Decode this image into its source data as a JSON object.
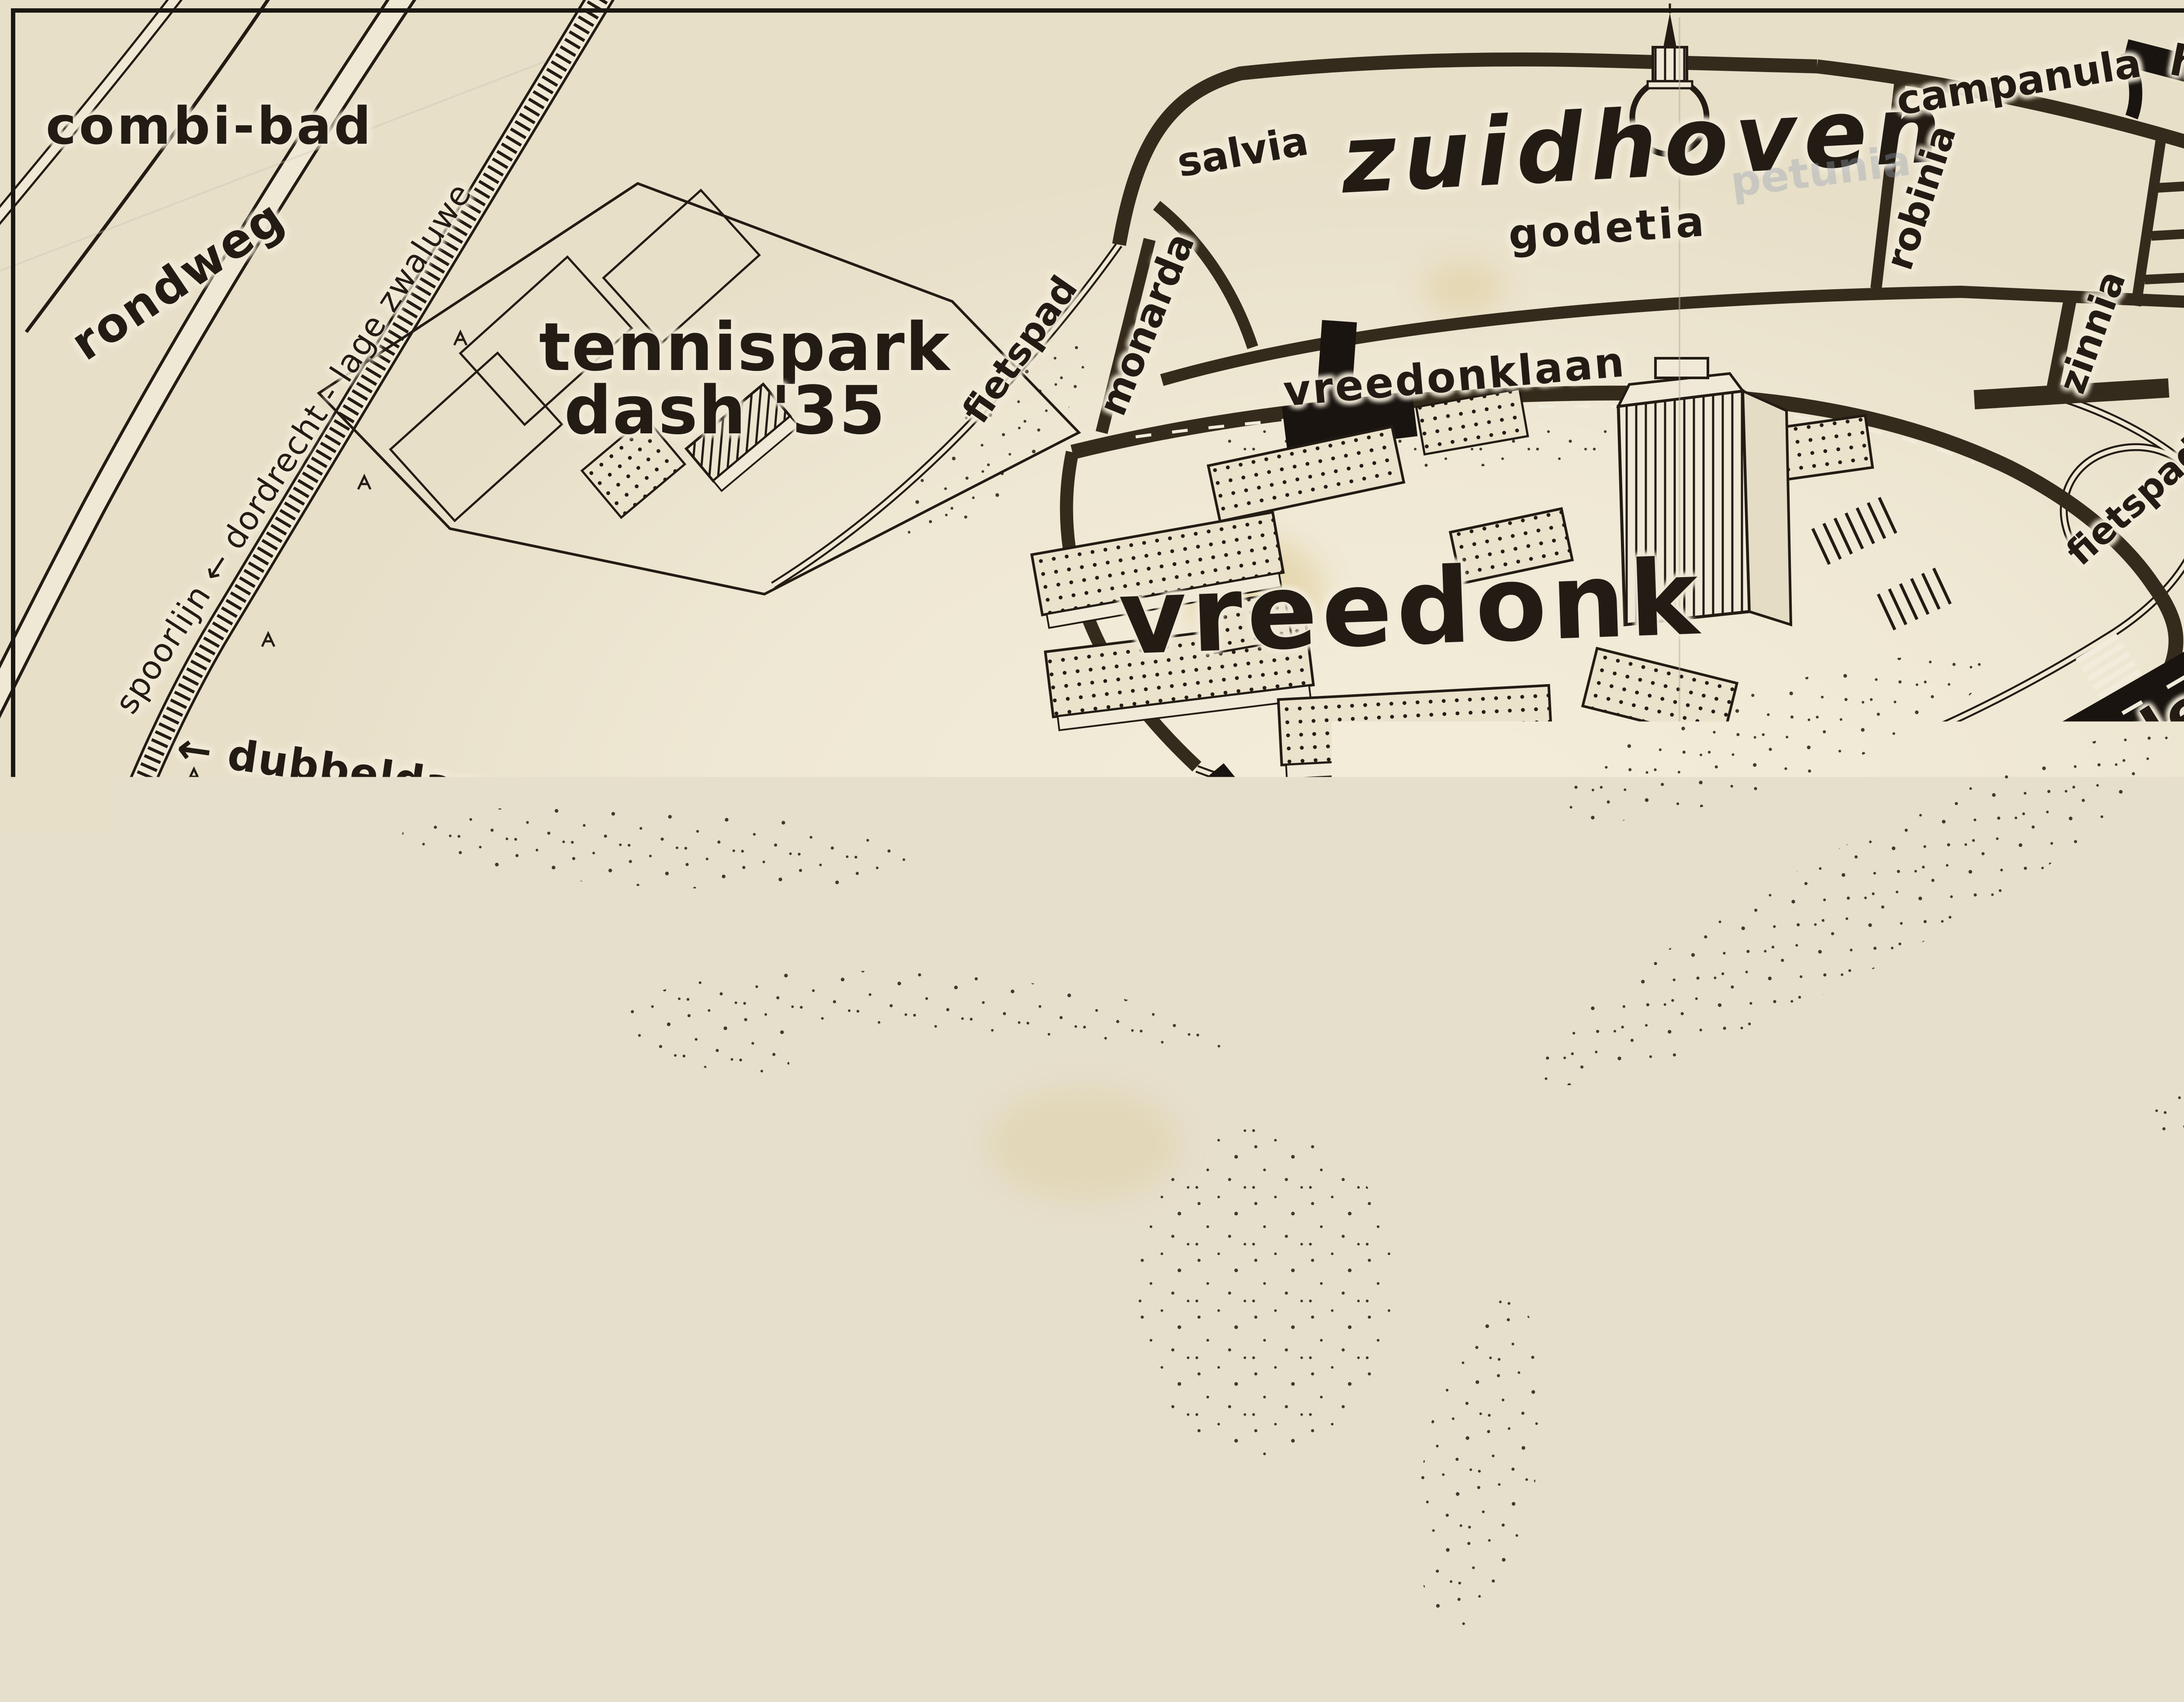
{
  "map": {
    "region_title": "zuidhoven",
    "colors": {
      "paper": "#f0e9d7",
      "ink": "#221c14",
      "road_black": "#191410",
      "street_brown": "#352b1c",
      "stain_yellow": "#d8bd78"
    },
    "copyright": {
      "signature": "Beckman",
      "label": "COPYRIGHT"
    },
    "labels": {
      "combi_bad": "combi-bad",
      "rondweg": "rondweg",
      "spoorlijn": "spoorlijn ← dordrecht - lage zwaluwe",
      "tennispark_line1": "tennispark",
      "tennispark_line2": "dash '35",
      "fietspad": "fietspad",
      "voetpad": "voetpad",
      "monarda": "monarda",
      "salvia": "salvia",
      "zuidhoven": "zuidhoven",
      "godetia": "godetia",
      "campanula": "campanula",
      "hugo_van_gijnweg": "hugo van gijnweg",
      "robinia": "robinia",
      "zinnia": "zinnia",
      "petunia_erased": "petunia",
      "vreedonklaan": "vreedonklaan",
      "vreedonk": "vreedonk",
      "centrum_dordt": "centrum dordt → rotterdam → breda",
      "laan_der_verenigde_naties": "laan der verenigde naties",
      "dubbeldam_papendrecht": "← dubbeldam ← papendrecht",
      "willem_school_line1": "willem de",
      "willem_school_line2": "zwijger",
      "willem_school_line3": "school",
      "zwijgerlaan_part": "zwijgerlaan",
      "willem_de_part": "willem de",
      "dependance_line1": "dependance",
      "dependance_line2": "gem.pedagogische",
      "dependance_line3": "academie",
      "ducdalf": "ducdalf",
      "nassauweg": "nassauweg",
      "nieuweweg": "nieuweweg"
    }
  }
}
